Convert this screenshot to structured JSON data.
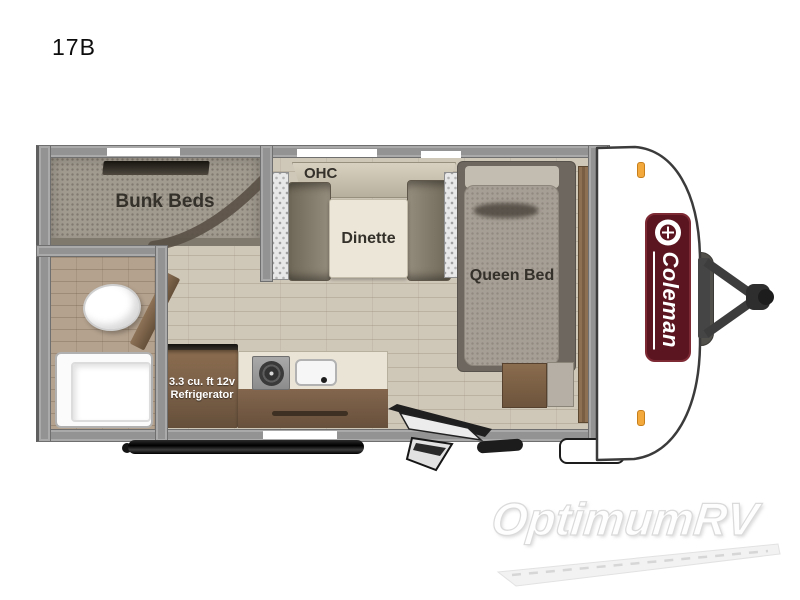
{
  "model": {
    "label": "17B"
  },
  "floorplan": {
    "labels": {
      "bunk_beds": "Bunk Beds",
      "ohc": "OHC",
      "dinette": "Dinette",
      "queen_bed": "Queen Bed",
      "refrigerator_line1": "3.3 cu. ft 12v",
      "refrigerator_line2": "Refrigerator"
    },
    "brand_badge": {
      "text": "Coleman"
    },
    "icons": {
      "brand_logo": "coleman-lantern-icon",
      "clearance_lights": "orange-marker-light",
      "fixtures": [
        "toilet",
        "tub-shower",
        "stove-burner",
        "sink",
        "entry-door-steps",
        "tongue-hitch",
        "awning-tube"
      ]
    },
    "colors": {
      "wall": "#939393",
      "floor_wood": "#cfc7b8",
      "tile": "#b4a28e",
      "carpet": "#a09a8f",
      "cabinet_brown": "#7c6149",
      "counter_top": "#eae4d6",
      "mattress_gray": "#a69f96",
      "badge_maroon": "#5a1520",
      "marker_light": "#f3a93c"
    }
  },
  "watermark": {
    "text": "OptimumRV"
  }
}
